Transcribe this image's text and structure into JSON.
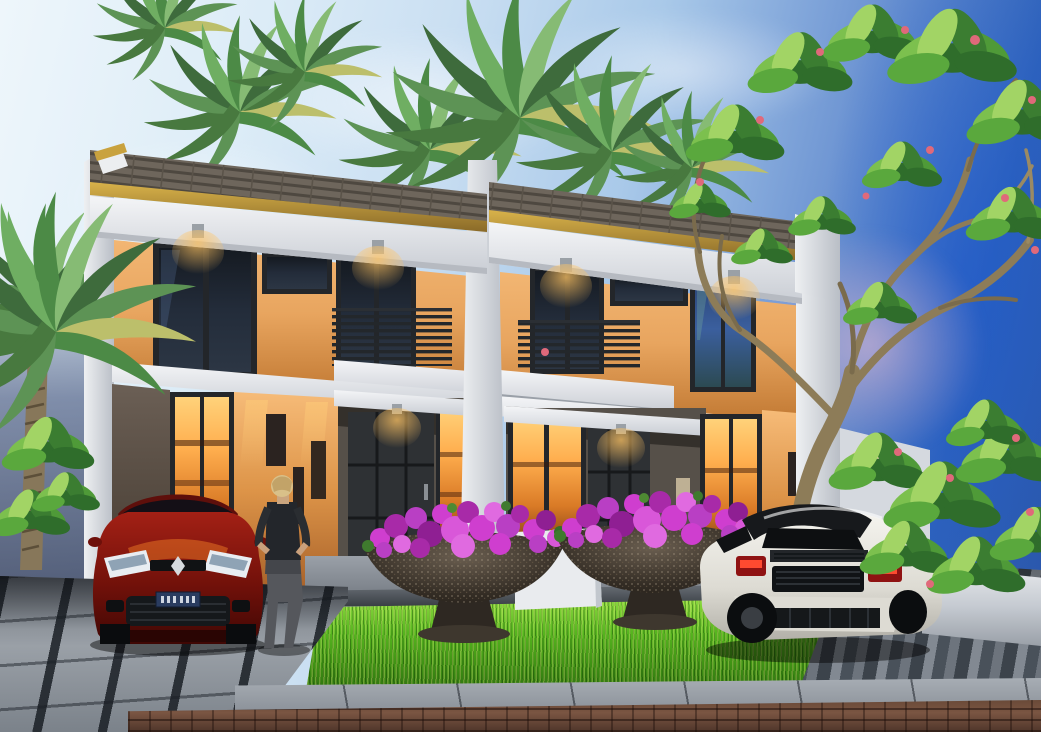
{
  "scene": {
    "title": "Dusk 3D architectural rendering of a modern two-storey duplex (twin house)",
    "time_of_day": "dusk",
    "objects": [
      {
        "name": "duplex-house",
        "detail": "two mirrored units, skillion grey tile roofs with gold fascia, white frames and pillars, orange feature walls, dark-framed glazing, centre-facing balconies with dark slat railings, warm interior lighting"
      },
      {
        "name": "red-car",
        "detail": "dark red hatchback parked facing viewer in left carport drive, blue European-style licence plate (characters illegible)"
      },
      {
        "name": "white-sports-car",
        "detail": "white low sports coupe seen from rear three-quarter on right drive, red tail lights, white licence plate (illegible)"
      },
      {
        "name": "person",
        "detail": "blonde woman in dark sleeveless top and grey trousers standing at left entry wall looking at posters"
      },
      {
        "name": "flower-planters",
        "detail": "two large dark stone bowl planters full of magenta bougainvillea flowers on pedestals"
      },
      {
        "name": "grass-bed",
        "detail": "raised bright green lawn strip with concrete kerb"
      },
      {
        "name": "palm-trees",
        "detail": "palms behind roof line and a tall palm at far left"
      },
      {
        "name": "frangipani-tree",
        "detail": "large sparse-branched tree with green leaf clusters and small pink flowers on right against deep blue sky"
      },
      {
        "name": "paving",
        "detail": "grey tiled driveways, paver sidewalk, brown brick road in foreground"
      }
    ]
  },
  "palette": {
    "skyTopLeft": "#eef6fb",
    "skyMid": "#a9c9e9",
    "skyRight": "#2e62bc",
    "skyDeep": "#2a55a8",
    "sunsetGlow": "#f0c2d4",
    "roofTile": "#6e665c",
    "roofTileDark": "#4e4840",
    "roofFascia": "#c9a23e",
    "roofFasciaDark": "#8a6a28",
    "wallWhite": "#eff0f3",
    "wallWhiteShade": "#c6cbd2",
    "wallOrange": "#e8a55f",
    "wallOrangeDeep": "#c0762f",
    "frameDark": "#23262a",
    "glassWarm": "#ffae4e",
    "glassWarmDeep": "#7a3a14",
    "glassCool": "#27406e",
    "grassLight": "#8edb3f",
    "grass": "#56b51f",
    "grassDark": "#2f7410",
    "flowerMagenta": "#cf3ecf",
    "flowerDeep": "#a82aa8",
    "planterStone": "#4a413a",
    "paveLight": "#9aa0a7",
    "paveDark": "#3c434b",
    "brick": "#6a4a38",
    "brickDark": "#4e352a",
    "carRed": "#a32015",
    "carRedDark": "#5f0d08",
    "carWhite": "#f2f1ec",
    "palmGreen": "#5d9355",
    "palmDeep": "#3e6b3c",
    "leafBright": "#7cc04e",
    "trunkTan": "#8d7c58",
    "personHair": "#d9c089",
    "personTop": "#23262b"
  }
}
